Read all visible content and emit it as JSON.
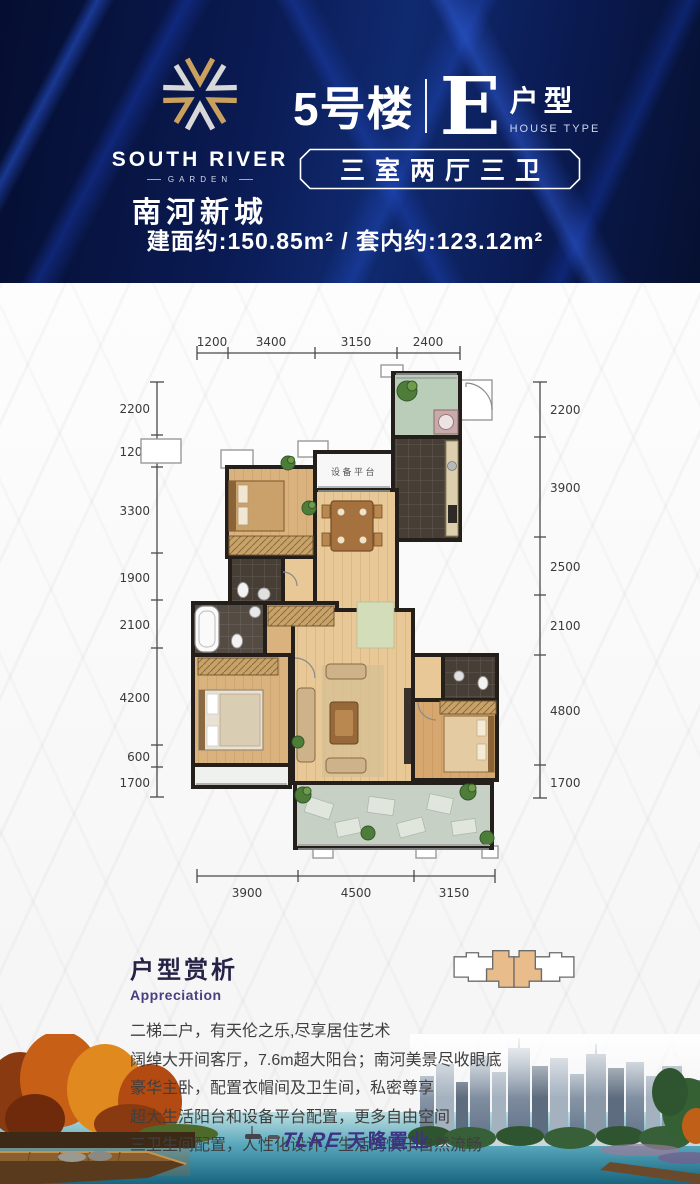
{
  "header": {
    "logo": {
      "name": "SOUTH RIVER",
      "sub": "GARDEN",
      "cn": "南河新城"
    },
    "building": "5号楼",
    "unit_letter": "E",
    "unit_label": "户型",
    "unit_label_en": "HOUSE TYPE",
    "layout_box": "三室两厅三卫",
    "area_line": "建面约:150.85m² / 套内约:123.12m²"
  },
  "floorplan": {
    "equipment_platform_label": "设备平台",
    "dims_top": [
      "1200",
      "3400",
      "3150",
      "2400"
    ],
    "dims_left": [
      "2200",
      "1200",
      "3300",
      "1900",
      "2100",
      "4200",
      "600",
      "1700"
    ],
    "dims_right": [
      "2200",
      "3900",
      "2500",
      "2100",
      "4800",
      "1700"
    ],
    "dims_bottom": [
      "3900",
      "4500",
      "3150"
    ]
  },
  "appreciation": {
    "title": "户型赏析",
    "subtitle": "Appreciation",
    "lines": [
      "二梯二户，有天伦之乐,尽享居住艺术",
      "阔绰大开间客厅，7.6m超大阳台；南河美景尽收眼底",
      "豪华主卧，配置衣帽间及卫生间，私密尊享",
      "超大生活阳台和设备平台配置，更多自由空间",
      "三卫生间配置，人性化设计，生活的快乐自然流畅"
    ]
  },
  "footer": {
    "developer_logo": "TLRE",
    "developer_cn": "天隆置业"
  },
  "colors": {
    "header_bg": "#0a1a52",
    "streak_blue": "#2d5feb",
    "title_navy": "#262347",
    "subtitle_purple": "#4a3f7f",
    "keyplan_highlight": "#e9bd8b",
    "wood_light": "#e7c896",
    "wood_mid": "#d9b27e",
    "tile_dark": "#473e36",
    "balcony_green": "#b9cdb9"
  }
}
